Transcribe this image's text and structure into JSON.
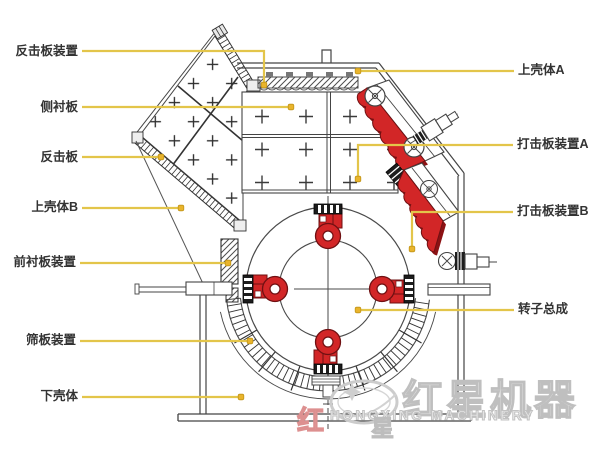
{
  "diagram": {
    "kind": "impact-crusher-structure-diagram",
    "colors": {
      "leader_line": "#e3c54a",
      "leader_dot": "#e9b42c",
      "leader_dot_edge": "#c29518",
      "part_red": "#d22627",
      "part_red_dark": "#8c1214",
      "line": "#4a4a4a",
      "watermark_gray": "#c9c9c9"
    },
    "labels_left": [
      {
        "text": "反击板装置",
        "lx": 78,
        "ly": 52,
        "path": [
          [
            82,
            51
          ],
          [
            264,
            51
          ],
          [
            264,
            82
          ]
        ],
        "dot": [
          264,
          85
        ]
      },
      {
        "text": "侧衬板",
        "lx": 78,
        "ly": 108,
        "path": [
          [
            82,
            107
          ],
          [
            288,
            107
          ]
        ],
        "dot": [
          291,
          107
        ]
      },
      {
        "text": "反击板",
        "lx": 78,
        "ly": 158,
        "path": [
          [
            82,
            157
          ],
          [
            158,
            157
          ]
        ],
        "dot": [
          161,
          157
        ]
      },
      {
        "text": "上壳体B",
        "lx": 78,
        "ly": 208,
        "path": [
          [
            82,
            208
          ],
          [
            178,
            208
          ]
        ],
        "dot": [
          181,
          208
        ]
      },
      {
        "text": "前衬板装置",
        "lx": 76,
        "ly": 263,
        "path": [
          [
            80,
            263
          ],
          [
            225,
            263
          ]
        ],
        "dot": [
          228,
          263
        ]
      },
      {
        "text": "筛板装置",
        "lx": 76,
        "ly": 341,
        "path": [
          [
            80,
            341
          ],
          [
            247,
            341
          ]
        ],
        "dot": [
          250,
          341
        ]
      },
      {
        "text": "下壳体",
        "lx": 78,
        "ly": 397,
        "path": [
          [
            82,
            397
          ],
          [
            238,
            397
          ]
        ],
        "dot": [
          241,
          397
        ]
      }
    ],
    "labels_right": [
      {
        "text": "上壳体A",
        "lx": 518,
        "ly": 71,
        "path": [
          [
            514,
            71
          ],
          [
            361,
            71
          ]
        ],
        "dot": [
          358,
          71
        ]
      },
      {
        "text": "打击板装置A",
        "lx": 517,
        "ly": 145,
        "path": [
          [
            513,
            145
          ],
          [
            358,
            145
          ],
          [
            358,
            176
          ]
        ],
        "dot": [
          358,
          179
        ]
      },
      {
        "text": "打击板装置B",
        "lx": 517,
        "ly": 212,
        "path": [
          [
            513,
            212
          ],
          [
            412,
            212
          ],
          [
            412,
            246
          ]
        ],
        "dot": [
          412,
          249
        ]
      },
      {
        "text": "转子总成",
        "lx": 518,
        "ly": 310,
        "path": [
          [
            514,
            310
          ],
          [
            361,
            310
          ]
        ],
        "dot": [
          358,
          310
        ]
      }
    ],
    "watermark": {
      "brand_cn": "红星机器",
      "brand_en": "HONGXING MACHINERY",
      "fragment_red": "红",
      "fragment_gray": "星"
    }
  }
}
